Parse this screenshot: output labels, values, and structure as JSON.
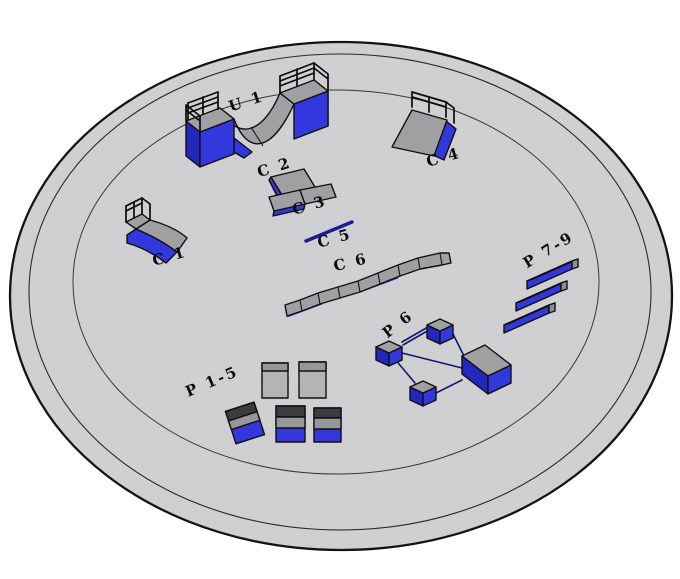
{
  "scene": {
    "labels": {
      "u1": "U 1",
      "c1": "C 1",
      "c2": "C 2",
      "c3": "C 3",
      "c4": "C 4",
      "c5": "C 5",
      "c6": "C 6",
      "p15": "P 1-5",
      "p6": "P 6",
      "p79": "P 7-9"
    },
    "colors": {
      "background": "#ffffff",
      "concrete": "#d2d2d4",
      "obstacle_top_gray": "#a0a0a2",
      "obstacle_blue": "#3338dc",
      "obstacle_blue_dark": "#2327bd",
      "rail_navy": "#1c1c96",
      "outline": "#101010"
    }
  }
}
